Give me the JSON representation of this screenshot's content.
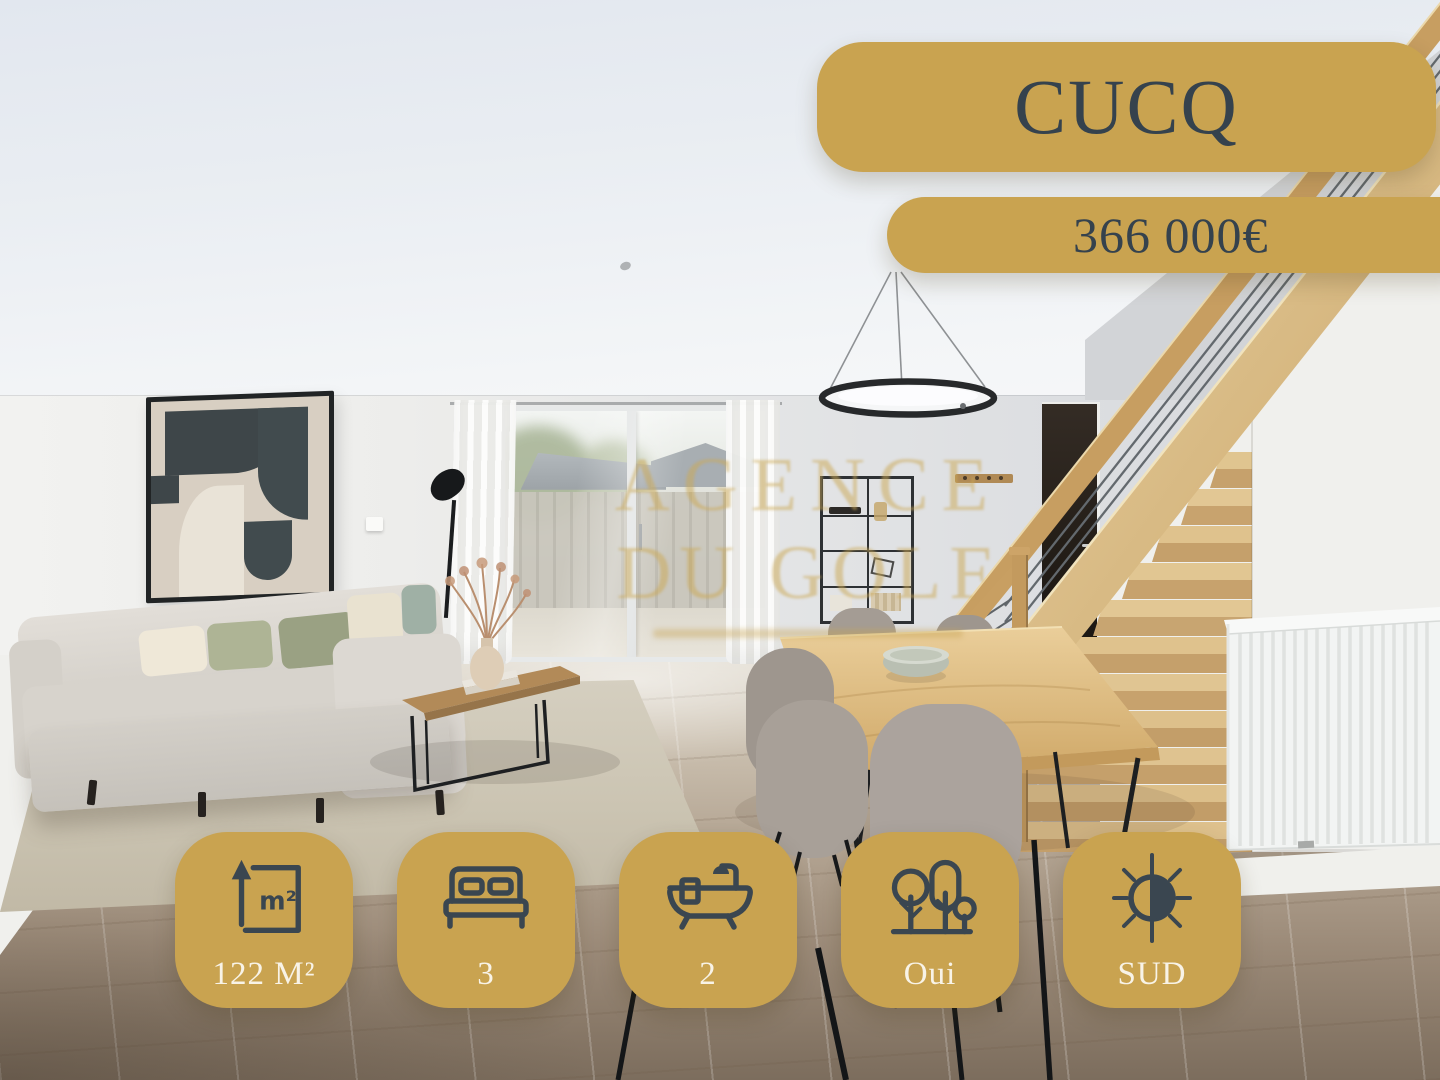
{
  "colors": {
    "gold": "#C9A350",
    "badge_text_dark": "#35424D",
    "badge_text_light": "#F8F3E7",
    "icon_stroke": "#3A4650",
    "watermark_gold": "rgba(203,168,86,0.52)"
  },
  "listing": {
    "city": "CUCQ",
    "price": "366 000€",
    "features": [
      {
        "icon": "area-icon",
        "label": "122 M²"
      },
      {
        "icon": "bed-icon",
        "label": "3"
      },
      {
        "icon": "bathtub-icon",
        "label": "2"
      },
      {
        "icon": "garden-trees-icon",
        "label": "Oui"
      },
      {
        "icon": "sun-orientation-icon",
        "label": "SUD"
      }
    ],
    "watermark": {
      "line1": "AGENCE",
      "line2": "DU GOLF"
    }
  }
}
